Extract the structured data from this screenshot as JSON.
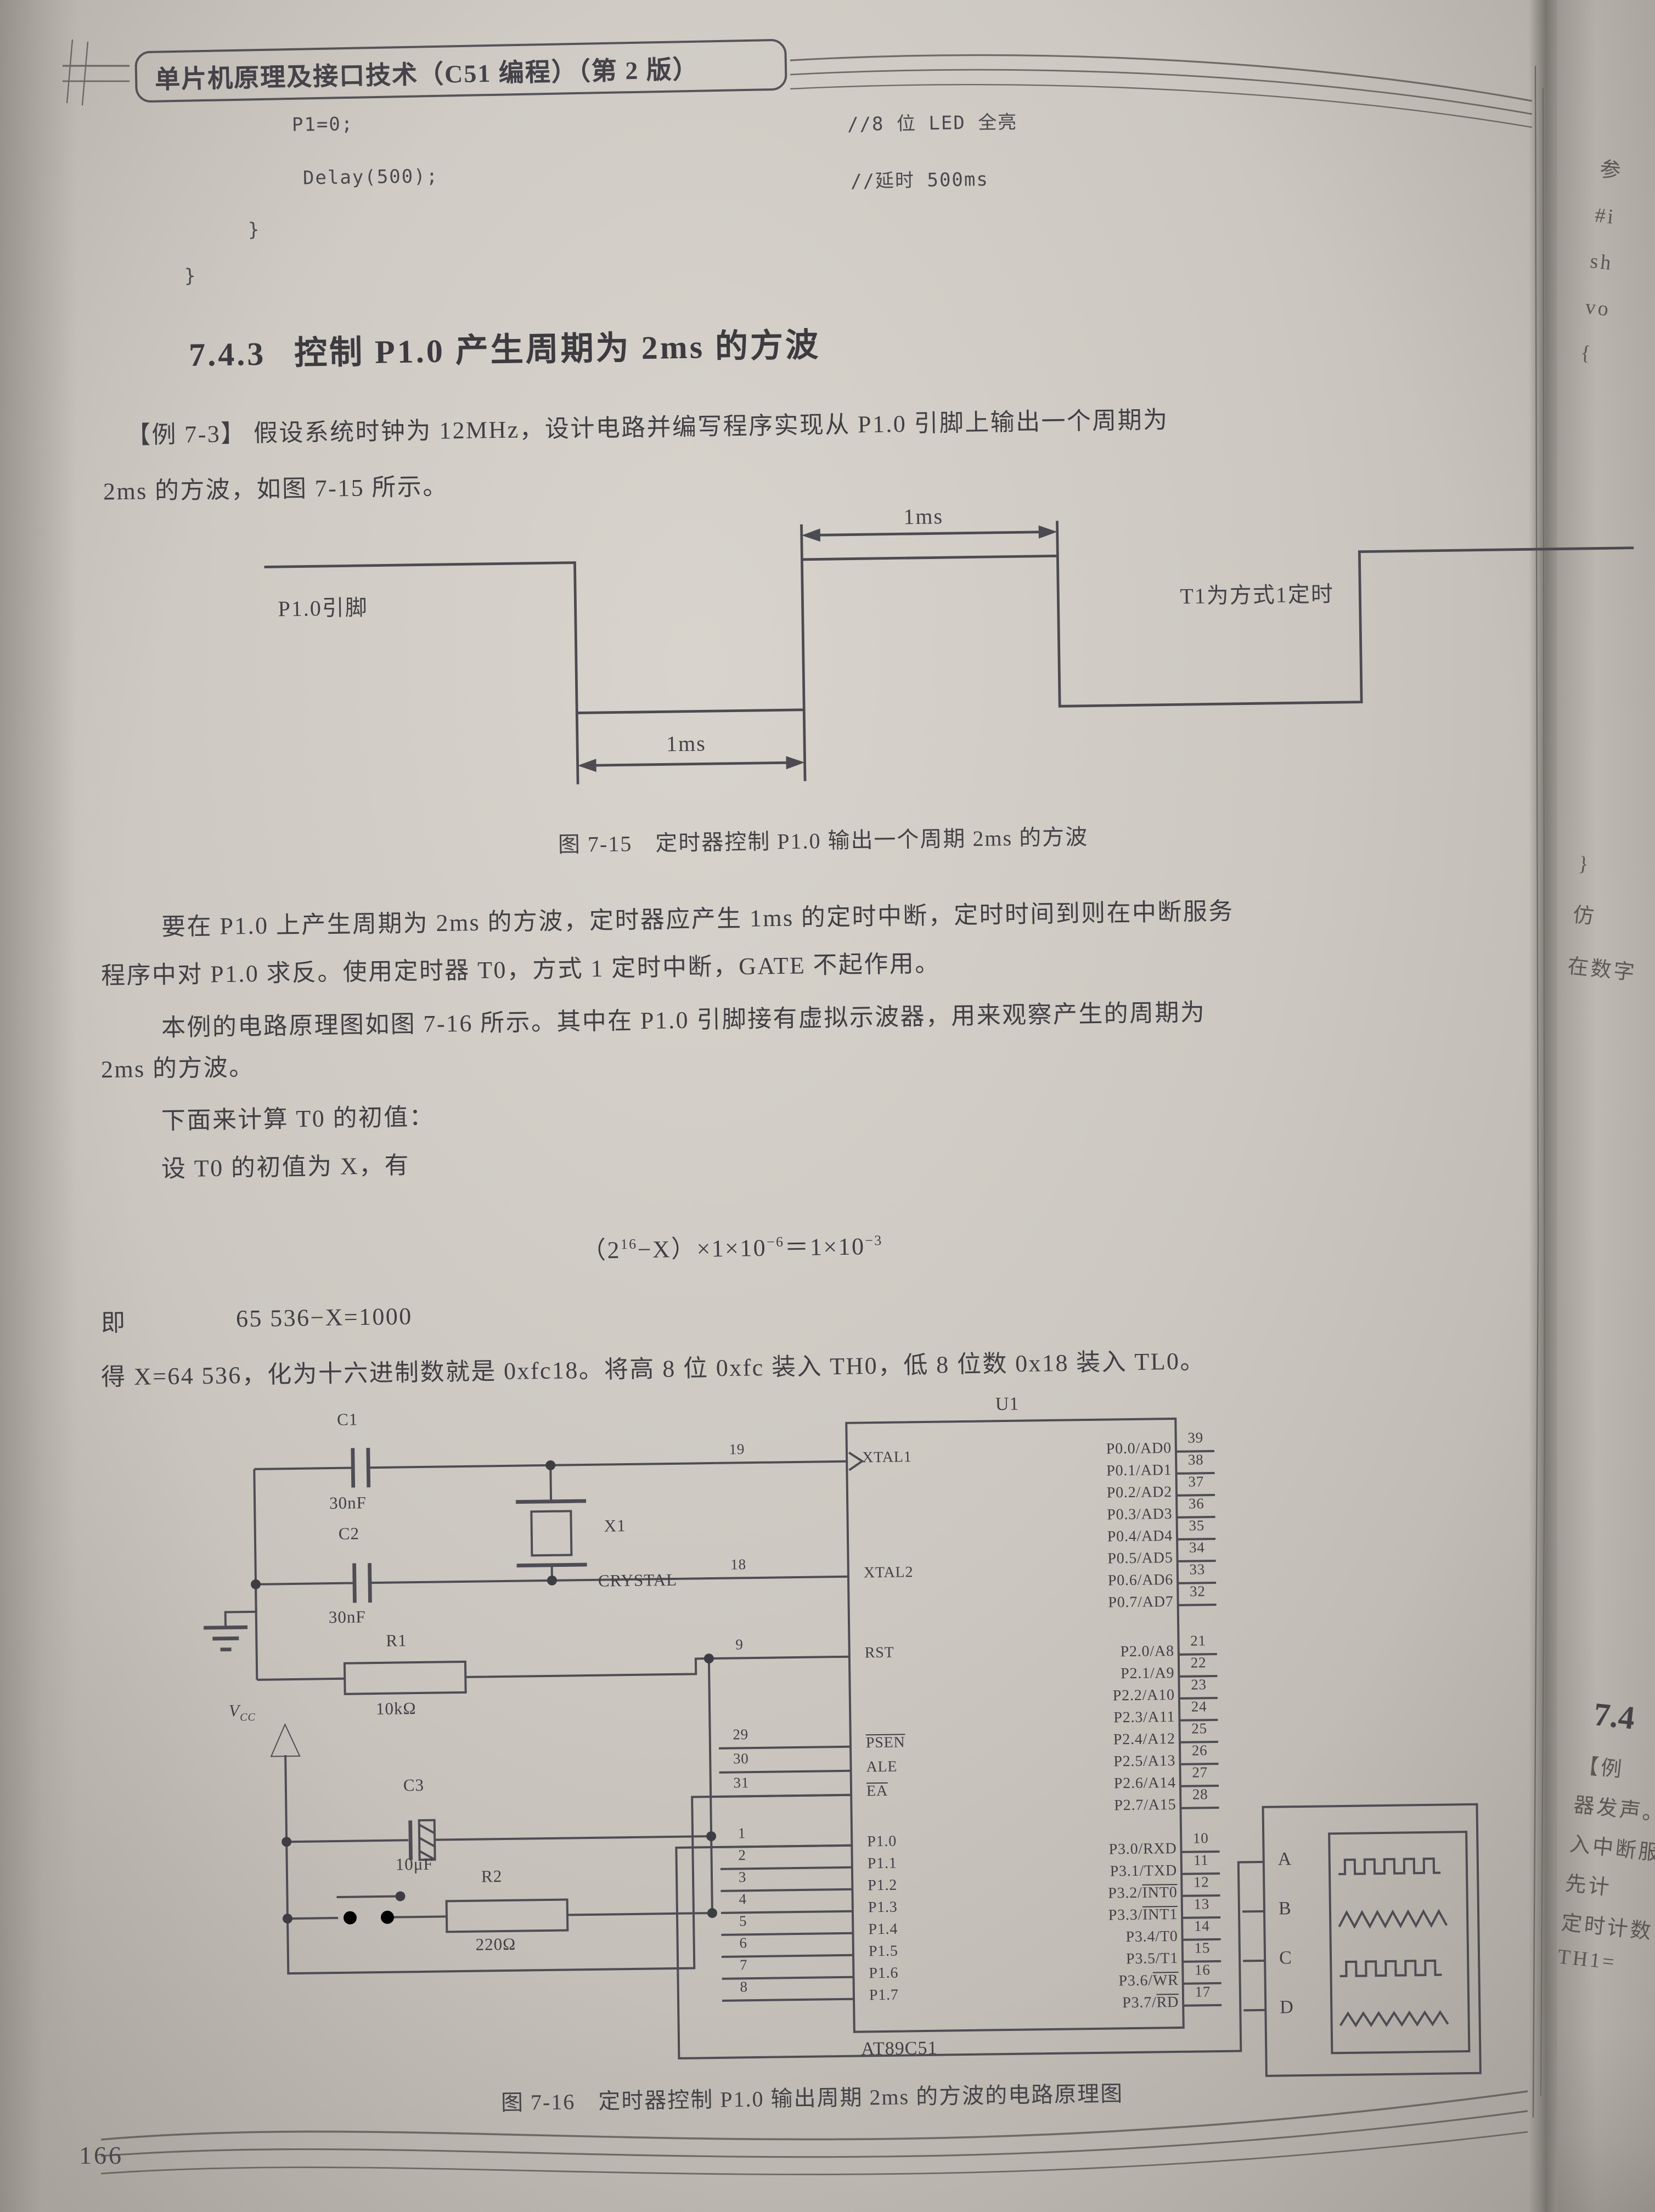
{
  "header": {
    "title": "单片机原理及接口技术（C51 编程）（第 2 版）"
  },
  "code": {
    "line1": "P1=0;",
    "line2": "Delay(500);",
    "brace1": "}",
    "brace2": "}",
    "comment1": "//8 位 LED 全亮",
    "comment2": "//延时 500ms"
  },
  "section": {
    "number": "7.4.3",
    "title": "控制 P1.0 产生周期为 2ms 的方波"
  },
  "example": {
    "line1": "【例 7-3】  假设系统时钟为 12MHz，设计电路并编写程序实现从 P1.0 引脚上输出一个周期为",
    "line2": "2ms 的方波，如图 7-15 所示。"
  },
  "fig15": {
    "pin_label": "P1.0引脚",
    "timer_label": "T1为方式1定时",
    "dim_top": "1ms",
    "dim_bottom": "1ms",
    "caption": "图 7-15　定时器控制 P1.0 输出一个周期 2ms 的方波"
  },
  "para1": {
    "line1": "要在 P1.0 上产生周期为 2ms 的方波，定时器应产生 1ms 的定时中断，定时时间到则在中断服务",
    "line2": "程序中对 P1.0 求反。使用定时器 T0，方式 1 定时中断，GATE 不起作用。",
    "line3": "本例的电路原理图如图 7-16 所示。其中在 P1.0 引脚接有虚拟示波器，用来观察产生的周期为",
    "line4": "2ms 的方波。"
  },
  "calc": {
    "line1": "下面来计算 T0 的初值：",
    "line2": "设 T0 的初值为 X，有",
    "formula": {
      "s1": "（2",
      "e1": "16",
      "s2": "−X）×1×10",
      "e2": "−6",
      "s3": "＝1×10",
      "e3": "−3"
    },
    "then_label": "即",
    "then_eq": "65 536−X=1000",
    "result": "得 X=64 536，化为十六进制数就是 0xfc18。将高 8 位 0xfc 装入 TH0，低 8 位数 0x18 装入 TL0。"
  },
  "fig16": {
    "caption": "图 7-16　定时器控制 P1.0 输出周期 2ms 的方波的电路原理图",
    "chip": {
      "ref": "U1",
      "part": "AT89C51",
      "left_pins": [
        {
          "num": "19",
          "name": "XTAL1"
        },
        {
          "num": "18",
          "name": "XTAL2"
        },
        {
          "num": "9",
          "name": "RST"
        },
        {
          "num": "29",
          "name": "PSEN",
          "bar": true
        },
        {
          "num": "30",
          "name": "ALE"
        },
        {
          "num": "31",
          "name": "EA",
          "bar": true
        },
        {
          "num": "1",
          "name": "P1.0"
        },
        {
          "num": "2",
          "name": "P1.1"
        },
        {
          "num": "3",
          "name": "P1.2"
        },
        {
          "num": "4",
          "name": "P1.3"
        },
        {
          "num": "5",
          "name": "P1.4"
        },
        {
          "num": "6",
          "name": "P1.5"
        },
        {
          "num": "7",
          "name": "P1.6"
        },
        {
          "num": "8",
          "name": "P1.7"
        }
      ],
      "right_pins_p0": [
        {
          "name": "P0.0/AD0",
          "num": "39"
        },
        {
          "name": "P0.1/AD1",
          "num": "38"
        },
        {
          "name": "P0.2/AD2",
          "num": "37"
        },
        {
          "name": "P0.3/AD3",
          "num": "36"
        },
        {
          "name": "P0.4/AD4",
          "num": "35"
        },
        {
          "name": "P0.5/AD5",
          "num": "34"
        },
        {
          "name": "P0.6/AD6",
          "num": "33"
        },
        {
          "name": "P0.7/AD7",
          "num": "32"
        }
      ],
      "right_pins_p2": [
        {
          "name": "P2.0/A8",
          "num": "21"
        },
        {
          "name": "P2.1/A9",
          "num": "22"
        },
        {
          "name": "P2.2/A10",
          "num": "23"
        },
        {
          "name": "P2.3/A11",
          "num": "24"
        },
        {
          "name": "P2.4/A12",
          "num": "25"
        },
        {
          "name": "P2.5/A13",
          "num": "26"
        },
        {
          "name": "P2.6/A14",
          "num": "27"
        },
        {
          "name": "P2.7/A15",
          "num": "28"
        }
      ],
      "right_pins_p3": [
        {
          "pre": "P3.0/RXD",
          "bar": "",
          "num": "10"
        },
        {
          "pre": "P3.1/TXD",
          "bar": "",
          "num": "11"
        },
        {
          "pre": "P3.2/",
          "bar": "INT0",
          "num": "12"
        },
        {
          "pre": "P3.3/",
          "bar": "INT1",
          "num": "13"
        },
        {
          "pre": "P3.4/T0",
          "bar": "",
          "num": "14"
        },
        {
          "pre": "P3.5/T1",
          "bar": "",
          "num": "15"
        },
        {
          "pre": "P3.6/",
          "bar": "WR",
          "num": "16"
        },
        {
          "pre": "P3.7/",
          "bar": "RD",
          "num": "17"
        }
      ]
    },
    "components": {
      "c1": "C1",
      "c1_val": "30nF",
      "c2": "C2",
      "c2_val": "30nF",
      "x1": "X1",
      "x1_val": "CRYSTAL",
      "r1": "R1",
      "r1_val": "10kΩ",
      "c3": "C3",
      "c3_val": "10μF",
      "r2": "R2",
      "r2_val": "220Ω",
      "vcc_main": "V",
      "vcc_sub": "CC"
    },
    "scope_inputs": [
      "A",
      "B",
      "C",
      "D"
    ]
  },
  "page_number": "166",
  "next_page": {
    "top_fragments": [
      "参",
      "#i",
      "sh",
      "vo",
      "{"
    ],
    "mid_fragments": [
      "}",
      "仿",
      "在数字"
    ],
    "bottom_heading": "7.4",
    "bottom_fragments": [
      "【例",
      "器发声。",
      "入中断服",
      "先计",
      "定时计数",
      "TH1="
    ]
  },
  "ink_color": "#3f3e42",
  "paper_color": "#ccc8c1"
}
